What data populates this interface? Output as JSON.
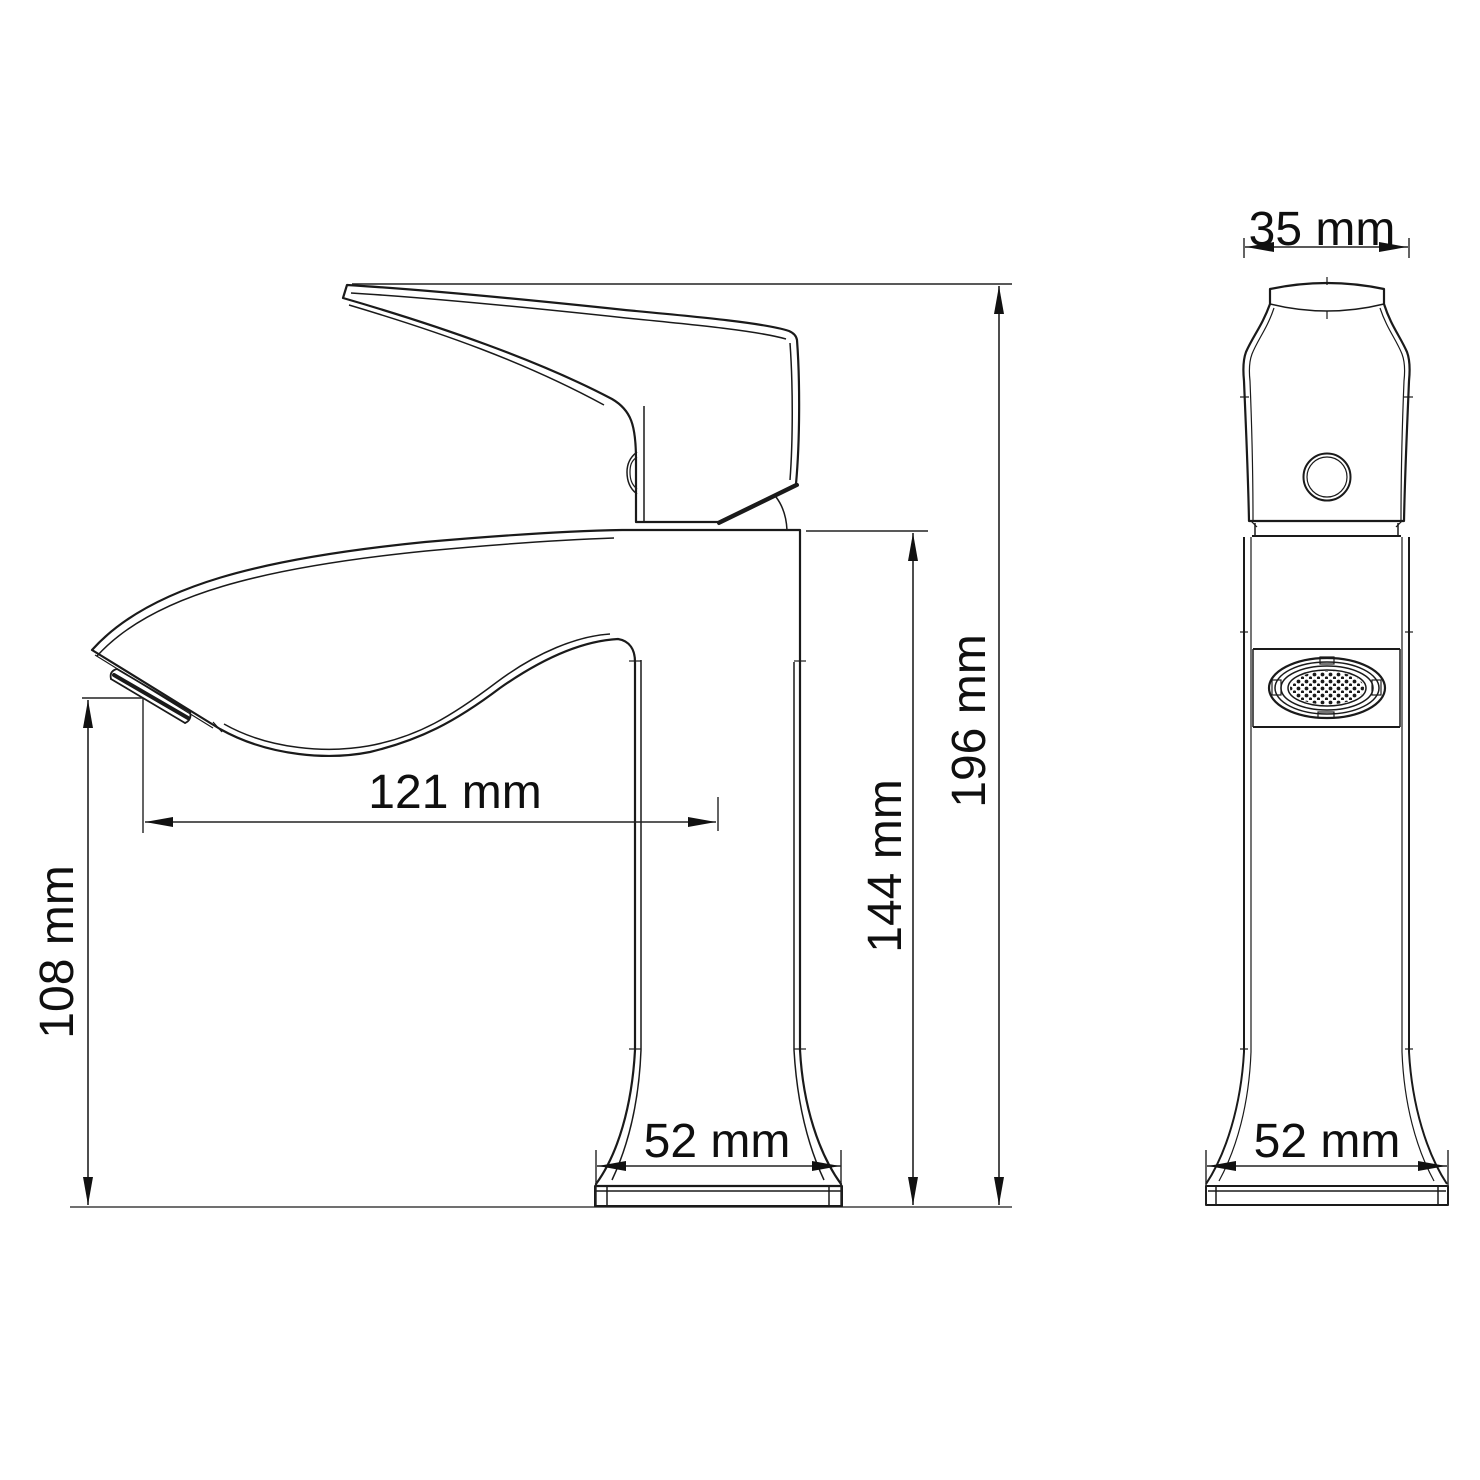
{
  "drawing": {
    "kind": "technical dimension drawing",
    "subject": "single-handle basin faucet, side and front views",
    "background_color": "#ffffff",
    "line_color": "#1a1a1a"
  },
  "side_view": {
    "dimensions": {
      "spout_height": {
        "label": "108 mm",
        "value": 108,
        "unit": "mm"
      },
      "spout_reach": {
        "label": "121 mm",
        "value": 121,
        "unit": "mm"
      },
      "body_height": {
        "label": "144 mm",
        "value": 144,
        "unit": "mm"
      },
      "total_height": {
        "label": "196 mm",
        "value": 196,
        "unit": "mm"
      },
      "base_width": {
        "label": "52 mm",
        "value": 52,
        "unit": "mm"
      }
    }
  },
  "front_view": {
    "dimensions": {
      "handle_width": {
        "label": "35 mm",
        "value": 35,
        "unit": "mm"
      },
      "base_width": {
        "label": "52 mm",
        "value": 52,
        "unit": "mm"
      }
    }
  }
}
